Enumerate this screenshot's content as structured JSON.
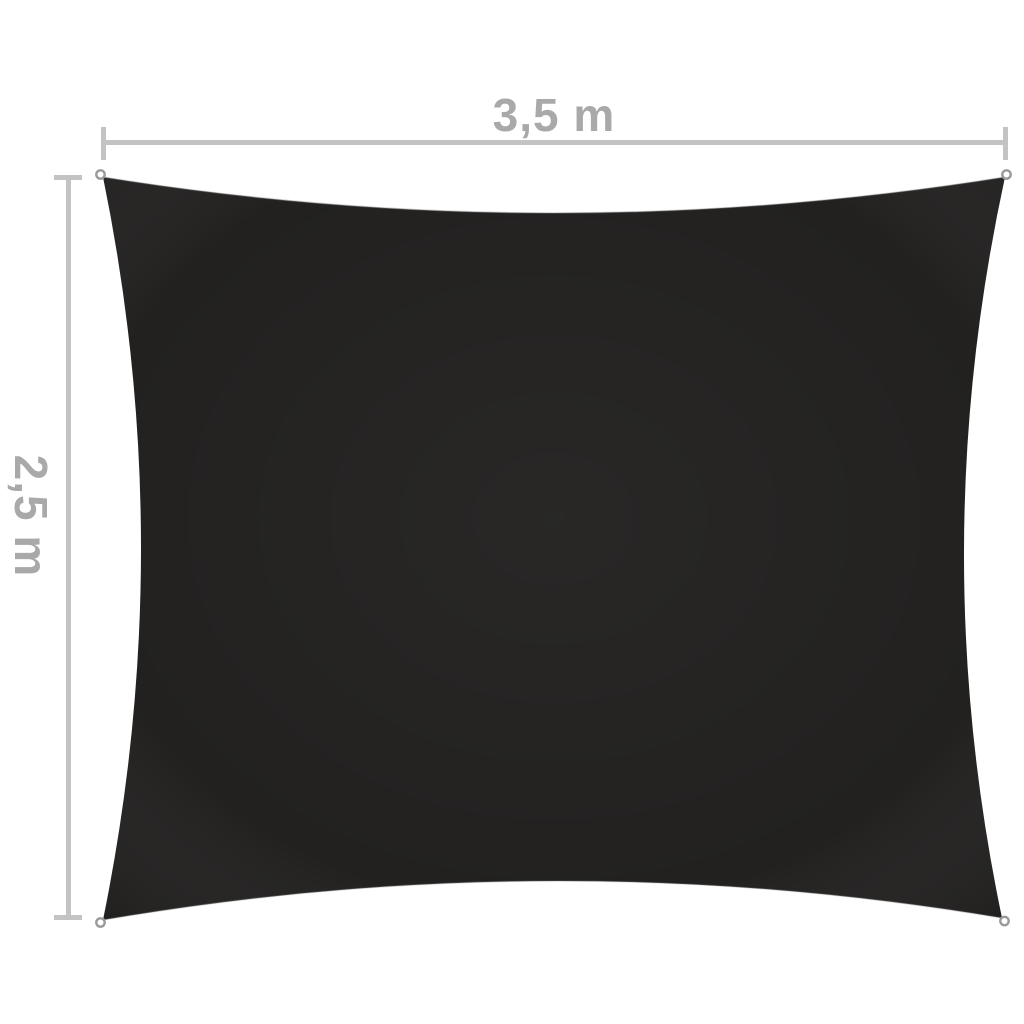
{
  "figure": {
    "type": "product-dimension-diagram",
    "subject": "rectangular shade sail, black fabric, concave edges, eyelet ring at each of the 4 corners",
    "width_label": "3,5 m",
    "height_label": "2,5 m",
    "corner_fittings_count": 4
  },
  "labels": {
    "width": "3,5 m",
    "height": "2,5 m"
  },
  "colors": {
    "bg": "#ffffff",
    "sail": "#222120",
    "sail-edge-highlight": "#8d8d8d",
    "line": "#c3c3c3",
    "label": "#a9a9a9",
    "eyelet": "#9a9a9a"
  }
}
